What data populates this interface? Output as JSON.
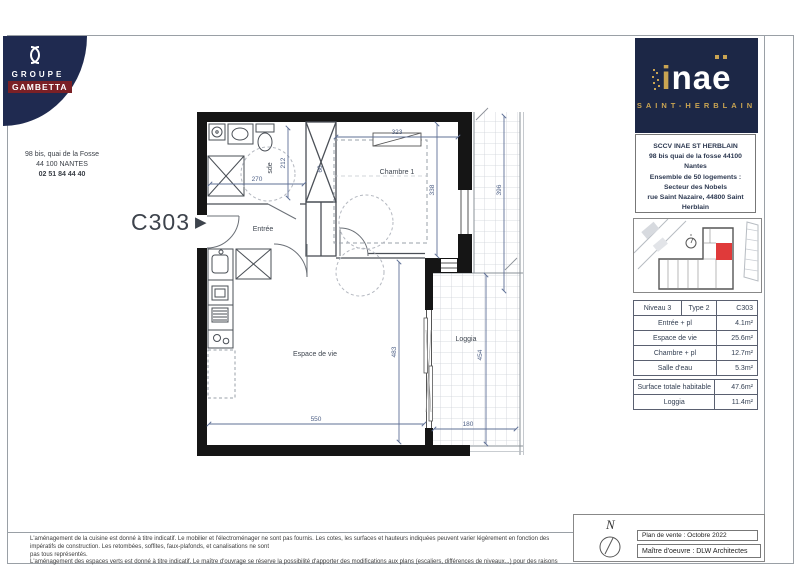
{
  "branding": {
    "groupe": "GROUPE",
    "gambetta": "GAMBETTA",
    "address": {
      "line1": "98 bis, quai de la Fosse",
      "line2": "44 100 NANTES",
      "phone": "02 51 84 44 40"
    }
  },
  "unit_label": {
    "text": "C303",
    "arrow": "▶"
  },
  "project": {
    "logo": {
      "i": "i",
      "na": "na",
      "e": "e",
      "city": "SAINT-HERBLAIN"
    },
    "sccv": {
      "line1": "SCCV INAE ST HERBLAIN",
      "line2": "98 bis quai de la fosse 44100 Nantes",
      "line3": "Ensemble de 50 logements :",
      "line4": "Secteur des Nobels",
      "line5": "rue Saint Nazaire, 44800 Saint Herblain"
    }
  },
  "table": {
    "header": {
      "niveau": "Niveau 3",
      "type": "Type 2",
      "unit": "C303"
    },
    "rows": [
      {
        "label": "Entrée + pl",
        "value": "4.1m²"
      },
      {
        "label": "Espace de vie",
        "value": "25.6m²"
      },
      {
        "label": "Chambre + pl",
        "value": "12.7m²"
      },
      {
        "label": "Salle d'eau",
        "value": "5.3m²"
      }
    ],
    "totals": [
      {
        "label": "Surface totale habitable",
        "value": "47.6m²"
      },
      {
        "label": "Loggia",
        "value": "11.4m²"
      }
    ]
  },
  "plan": {
    "labels": {
      "sde": "sde",
      "entree": "Entrée",
      "chambre": "Chambre 1",
      "espace": "Espace de vie",
      "loggia": "Loggia"
    },
    "dims": {
      "d212": "212",
      "d270": "270",
      "d60": "60",
      "d323": "323",
      "d338": "338",
      "d396": "396",
      "d483": "483",
      "d550": "550",
      "d454": "454",
      "d180": "180"
    }
  },
  "footer": {
    "legal1": "L'aménagement de la cuisine est donné à titre indicatif. Le mobilier et l'électroménager ne sont pas fournis. Les cotes, les surfaces et hauteurs indiquées peuvent varier légèrement en fonction des impératifs de construction. Les retombées, soffites, faux-plafonds, et canalisations ne sont",
    "legal2": "pas tous représentés.",
    "legal3": "L'aménagement des espaces verts est donné à titre indicatif. Le maître d'ouvrage se réserve la possibilité d'apporter des modifications aux plans (escaliers, différences de niveaux...) pour des raisons d'ordre technique ou administratives",
    "north": "N",
    "plan_vente": "Plan de vente : Octobre 2022",
    "maitre": "Maître d'oeuvre : DLW Architectes",
    "colors": {
      "accent_red": "#e03a3a",
      "navy": "#1c2746",
      "gold": "#c9a452"
    }
  }
}
